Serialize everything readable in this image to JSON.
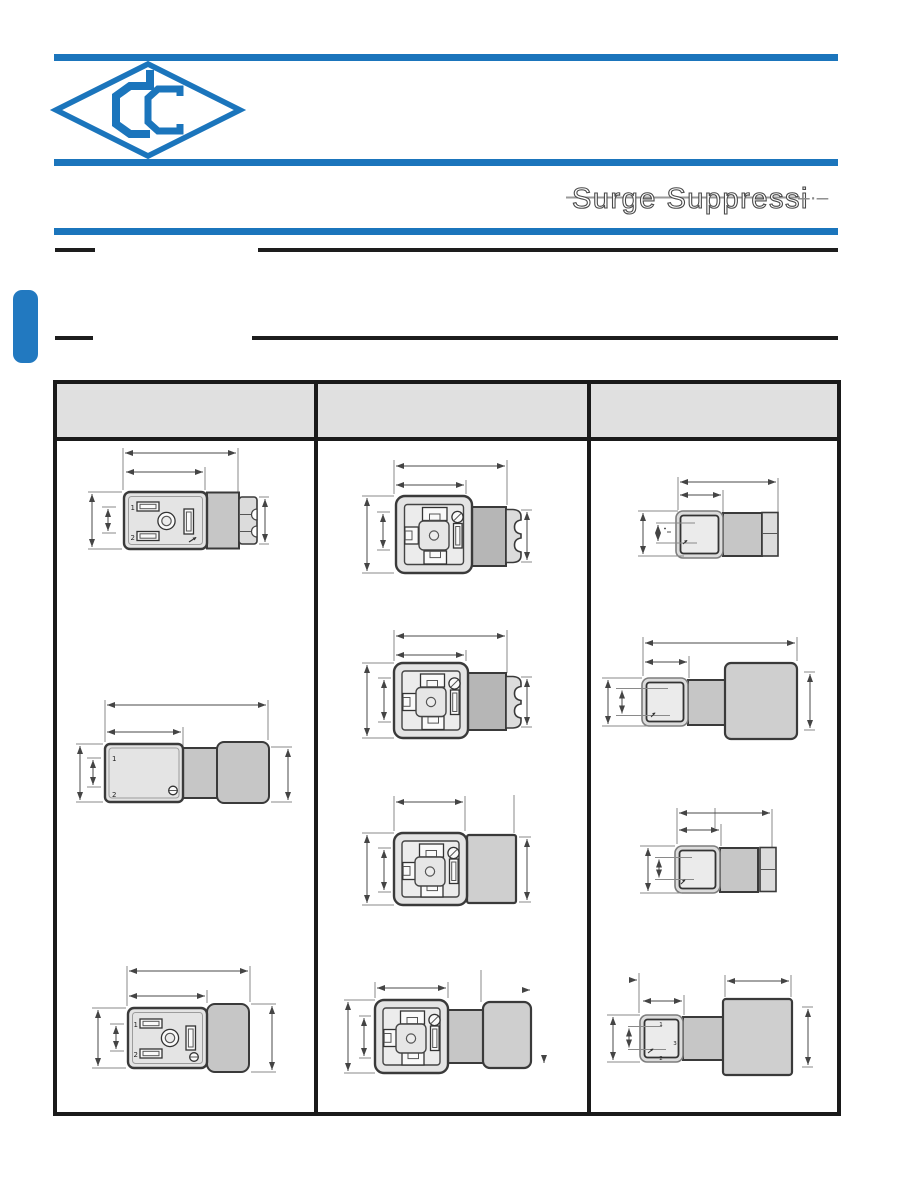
{
  "brand": {
    "accent_color": "#1b75bc",
    "logo_name": "cc-diamond-monogram"
  },
  "header": {
    "title": "Surge Suppressi",
    "title_trailing": "–·–"
  },
  "table": {
    "headers": [
      "",
      "",
      ""
    ],
    "columns": [
      {
        "name": "column-1",
        "drawings": [
          {
            "view": "front-view-with-stepped-cable-gland",
            "pins": {
              "p1": "1",
              "p2": "2"
            }
          },
          {
            "view": "side-view-with-cable-gland",
            "pins": {
              "p1": "1",
              "p2": "2"
            }
          },
          {
            "view": "front-view-with-block-gland",
            "pins": {
              "p1": "1",
              "p2": "2"
            }
          }
        ]
      },
      {
        "name": "column-2",
        "drawings": [
          {
            "view": "square-front-view-ribbed-gland"
          },
          {
            "view": "square-front-view-ribbed-gland"
          },
          {
            "view": "square-front-view-block"
          },
          {
            "view": "square-front-view-neck-and-block"
          }
        ]
      },
      {
        "name": "column-3",
        "drawings": [
          {
            "view": "small-square-side-view-gland"
          },
          {
            "view": "small-square-side-view-block"
          },
          {
            "view": "small-square-side-view-gland"
          },
          {
            "view": "small-square-side-view-block",
            "pins": {
              "p1": "1",
              "p2": "2",
              "p3": "3"
            }
          }
        ]
      }
    ]
  }
}
